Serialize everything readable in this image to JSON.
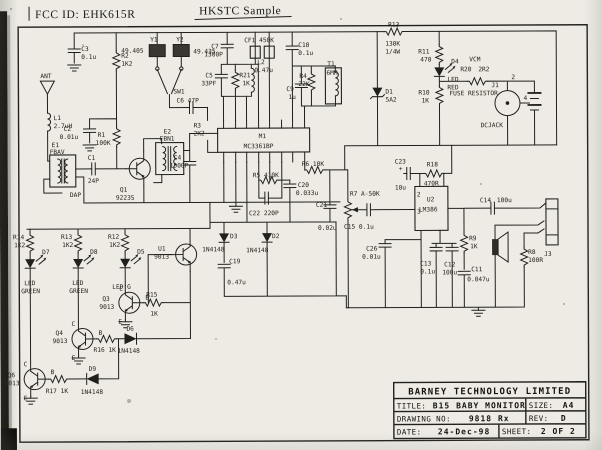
{
  "header": {
    "fcc_id": "FCC ID: EHK615R",
    "sample": "HKSTC Sample"
  },
  "title_block": {
    "company": "BARNEY TECHNOLOGY LIMITED",
    "title_label": "TITLE:",
    "title": "B15 BABY MONITOR",
    "size_label": "SIZE:",
    "size": "A4",
    "drawing_label": "DRAWING NO:",
    "drawing_no": "9818 Rx",
    "rev_label": "REV:",
    "rev": "D",
    "date_label": "DATE:",
    "date": "24-Dec-98",
    "sheet_label": "SHEET:",
    "sheet": "2 OF 2"
  },
  "schematic": {
    "ic_main": "MC3361BP",
    "ic_audio": "LM386",
    "labels": [
      {
        "t": "C3",
        "x": 82,
        "y": 50
      },
      {
        "t": "0.1u",
        "x": 82,
        "y": 58
      },
      {
        "t": "R2",
        "x": 122,
        "y": 57
      },
      {
        "t": "1K2",
        "x": 122,
        "y": 65
      },
      {
        "t": "ANT",
        "x": 41,
        "y": 77
      },
      {
        "t": "L1",
        "x": 54,
        "y": 119
      },
      {
        "t": "2.7uH",
        "x": 54,
        "y": 127
      },
      {
        "t": "C2",
        "x": 64,
        "y": 130
      },
      {
        "t": "0.01u",
        "x": 60,
        "y": 138
      },
      {
        "t": "E1",
        "x": 52,
        "y": 146
      },
      {
        "t": "FBAV",
        "x": 50,
        "y": 153
      },
      {
        "t": "DAP",
        "x": 70,
        "y": 196
      },
      {
        "t": "C1",
        "x": 88,
        "y": 159
      },
      {
        "t": "24P",
        "x": 88,
        "y": 182
      },
      {
        "t": "R1",
        "x": 98,
        "y": 136
      },
      {
        "t": "100K",
        "x": 96,
        "y": 144
      },
      {
        "t": "Q1",
        "x": 120,
        "y": 191
      },
      {
        "t": "9223S",
        "x": 116,
        "y": 199
      },
      {
        "t": "Y1",
        "x": 151,
        "y": 41
      },
      {
        "t": "Y2",
        "x": 177,
        "y": 41
      },
      {
        "t": "49.405",
        "x": 122,
        "y": 52
      },
      {
        "t": "49.435",
        "x": 194,
        "y": 53
      },
      {
        "t": "SW1",
        "x": 174,
        "y": 93
      },
      {
        "t": "C6 47P",
        "x": 177,
        "y": 102
      },
      {
        "t": "C5",
        "x": 206,
        "y": 77
      },
      {
        "t": "33PF",
        "x": 202,
        "y": 85
      },
      {
        "t": "R21",
        "x": 240,
        "y": 77
      },
      {
        "t": "1K",
        "x": 243,
        "y": 85
      },
      {
        "t": "L2",
        "x": 258,
        "y": 64
      },
      {
        "t": "0.47u",
        "x": 255,
        "y": 72
      },
      {
        "t": "C7",
        "x": 212,
        "y": 48
      },
      {
        "t": "1300P",
        "x": 205,
        "y": 56
      },
      {
        "t": "CF1 450K",
        "x": 245,
        "y": 42
      },
      {
        "t": "C10",
        "x": 299,
        "y": 47
      },
      {
        "t": "0.1u",
        "x": 299,
        "y": 55
      },
      {
        "t": "C9",
        "x": 287,
        "y": 91
      },
      {
        "t": "1u",
        "x": 289,
        "y": 99
      },
      {
        "t": "R4",
        "x": 300,
        "y": 78
      },
      {
        "t": "22K",
        "x": 299,
        "y": 86
      },
      {
        "t": "T1",
        "x": 328,
        "y": 66
      },
      {
        "t": "6MM",
        "x": 327,
        "y": 75
      },
      {
        "t": "E2",
        "x": 164,
        "y": 133
      },
      {
        "t": "FBN1",
        "x": 160,
        "y": 140
      },
      {
        "t": "R3",
        "x": 194,
        "y": 127
      },
      {
        "t": "2K2",
        "x": 194,
        "y": 135
      },
      {
        "t": "C4",
        "x": 174,
        "y": 159
      },
      {
        "t": "1500P",
        "x": 170,
        "y": 167
      },
      {
        "t": "M1",
        "x": 259,
        "y": 138,
        "s": 7
      },
      {
        "t": "MC3361BP",
        "x": 244,
        "y": 148,
        "s": 7
      },
      {
        "t": "R13",
        "x": 389,
        "y": 27
      },
      {
        "t": "130K",
        "x": 386,
        "y": 46
      },
      {
        "t": "1/4W",
        "x": 386,
        "y": 54
      },
      {
        "t": "D1",
        "x": 386,
        "y": 94
      },
      {
        "t": "5A2",
        "x": 386,
        "y": 102
      },
      {
        "t": "R11",
        "x": 419,
        "y": 54
      },
      {
        "t": "470",
        "x": 421,
        "y": 62
      },
      {
        "t": "D4",
        "x": 452,
        "y": 64
      },
      {
        "t": "LED",
        "x": 448,
        "y": 82
      },
      {
        "t": "RED",
        "x": 448,
        "y": 90
      },
      {
        "t": "VCM",
        "x": 470,
        "y": 62
      },
      {
        "t": "R20",
        "x": 461,
        "y": 72
      },
      {
        "t": "2R2",
        "x": 479,
        "y": 72
      },
      {
        "t": "FUSE RESISTOR",
        "x": 450,
        "y": 96,
        "s": 5.5
      },
      {
        "t": "R10",
        "x": 419,
        "y": 95
      },
      {
        "t": "1K",
        "x": 422,
        "y": 103
      },
      {
        "t": "2",
        "x": 512,
        "y": 80,
        "s": 5
      },
      {
        "t": "J1",
        "x": 492,
        "y": 88
      },
      {
        "t": "4",
        "x": 524,
        "y": 101,
        "s": 5
      },
      {
        "t": "DCJACK",
        "x": 481,
        "y": 128
      },
      {
        "t": "R6 10K",
        "x": 302,
        "y": 166
      },
      {
        "t": "R5 410K",
        "x": 253,
        "y": 177
      },
      {
        "t": "C20",
        "x": 298,
        "y": 187
      },
      {
        "t": "0.033u",
        "x": 296,
        "y": 195
      },
      {
        "t": "C22 220P",
        "x": 249,
        "y": 215
      },
      {
        "t": "C21",
        "x": 316,
        "y": 207
      },
      {
        "t": "0.02u",
        "x": 318,
        "y": 230
      },
      {
        "t": "R7 A-50K",
        "x": 350,
        "y": 196
      },
      {
        "t": "C15 0.1u",
        "x": 344,
        "y": 229
      },
      {
        "t": "C23",
        "x": 395,
        "y": 164
      },
      {
        "t": "10u",
        "x": 395,
        "y": 190
      },
      {
        "t": "+",
        "x": 399,
        "y": 171,
        "s": 6
      },
      {
        "t": "R18",
        "x": 427,
        "y": 167
      },
      {
        "t": "470R",
        "x": 424,
        "y": 186
      },
      {
        "t": "U2",
        "x": 427,
        "y": 202,
        "s": 6.5
      },
      {
        "t": "LM386",
        "x": 419,
        "y": 212,
        "s": 6.5
      },
      {
        "t": "2",
        "x": 417,
        "y": 197,
        "s": 4.5
      },
      {
        "t": "3",
        "x": 417,
        "y": 214,
        "s": 4.5
      },
      {
        "t": "C26",
        "x": 366,
        "y": 251
      },
      {
        "t": "0.01u",
        "x": 362,
        "y": 259
      },
      {
        "t": "C13",
        "x": 420,
        "y": 266
      },
      {
        "t": "0.1u",
        "x": 420,
        "y": 274
      },
      {
        "t": "C12",
        "x": 444,
        "y": 267
      },
      {
        "t": "100u",
        "x": 442,
        "y": 275
      },
      {
        "t": "R9",
        "x": 469,
        "y": 241
      },
      {
        "t": "1K",
        "x": 470,
        "y": 249
      },
      {
        "t": "C11",
        "x": 471,
        "y": 272
      },
      {
        "t": "0.047u",
        "x": 467,
        "y": 282
      },
      {
        "t": "C14",
        "x": 480,
        "y": 203
      },
      {
        "t": "100u",
        "x": 497,
        "y": 203
      },
      {
        "t": "J3",
        "x": 544,
        "y": 257
      },
      {
        "t": "R8",
        "x": 528,
        "y": 255
      },
      {
        "t": "100R",
        "x": 528,
        "y": 263
      },
      {
        "t": "D3",
        "x": 230,
        "y": 238
      },
      {
        "t": "1N4148",
        "x": 202,
        "y": 251
      },
      {
        "t": "D2",
        "x": 272,
        "y": 238
      },
      {
        "t": "1N4148",
        "x": 246,
        "y": 252
      },
      {
        "t": "C19",
        "x": 229,
        "y": 263
      },
      {
        "t": "0.47u",
        "x": 227,
        "y": 284
      },
      {
        "t": "R14",
        "x": 13,
        "y": 238
      },
      {
        "t": "1K2",
        "x": 14,
        "y": 246
      },
      {
        "t": "D7",
        "x": 42,
        "y": 253
      },
      {
        "t": "LED",
        "x": 24,
        "y": 284
      },
      {
        "t": "GREEN",
        "x": 21,
        "y": 292
      },
      {
        "t": "R13",
        "x": 61,
        "y": 238
      },
      {
        "t": "1K2",
        "x": 62,
        "y": 246
      },
      {
        "t": "D8",
        "x": 90,
        "y": 253
      },
      {
        "t": "LED",
        "x": 72,
        "y": 284
      },
      {
        "t": "GREEN",
        "x": 69,
        "y": 292
      },
      {
        "t": "R12",
        "x": 108,
        "y": 238
      },
      {
        "t": "1K2",
        "x": 109,
        "y": 246
      },
      {
        "t": "D5",
        "x": 137,
        "y": 253
      },
      {
        "t": "LED G",
        "x": 112,
        "y": 288
      },
      {
        "t": "U1",
        "x": 158,
        "y": 250
      },
      {
        "t": "9013",
        "x": 154,
        "y": 258
      },
      {
        "t": "Q3",
        "x": 102,
        "y": 300
      },
      {
        "t": "9013",
        "x": 99,
        "y": 308
      },
      {
        "t": "R15",
        "x": 146,
        "y": 296
      },
      {
        "t": "1K",
        "x": 150,
        "y": 315
      },
      {
        "t": "Q4",
        "x": 55,
        "y": 334
      },
      {
        "t": "9013",
        "x": 52,
        "y": 342
      },
      {
        "t": "R16 1K",
        "x": 93,
        "y": 351
      },
      {
        "t": "D6",
        "x": 126,
        "y": 330
      },
      {
        "t": "1N4148",
        "x": 117,
        "y": 352
      },
      {
        "t": "Q6",
        "x": 7,
        "y": 376
      },
      {
        "t": "9013",
        "x": 4,
        "y": 384
      },
      {
        "t": "R17 1K",
        "x": 45,
        "y": 392
      },
      {
        "t": "D9",
        "x": 88,
        "y": 370
      },
      {
        "t": "1N4148",
        "x": 80,
        "y": 393
      },
      {
        "t": "C",
        "x": 119,
        "y": 290,
        "s": 4.5
      },
      {
        "t": "B",
        "x": 145,
        "y": 299,
        "s": 4.5
      },
      {
        "t": "E",
        "x": 118,
        "y": 323,
        "s": 4.5
      },
      {
        "t": "C",
        "x": 71,
        "y": 325,
        "s": 4.5
      },
      {
        "t": "B",
        "x": 98,
        "y": 334,
        "s": 4.5
      },
      {
        "t": "E",
        "x": 71,
        "y": 359,
        "s": 4.5
      },
      {
        "t": "C",
        "x": 23,
        "y": 365,
        "s": 4.5
      },
      {
        "t": "B",
        "x": 50,
        "y": 373,
        "s": 4.5
      },
      {
        "t": "E",
        "x": 23,
        "y": 399,
        "s": 4.5
      }
    ]
  }
}
